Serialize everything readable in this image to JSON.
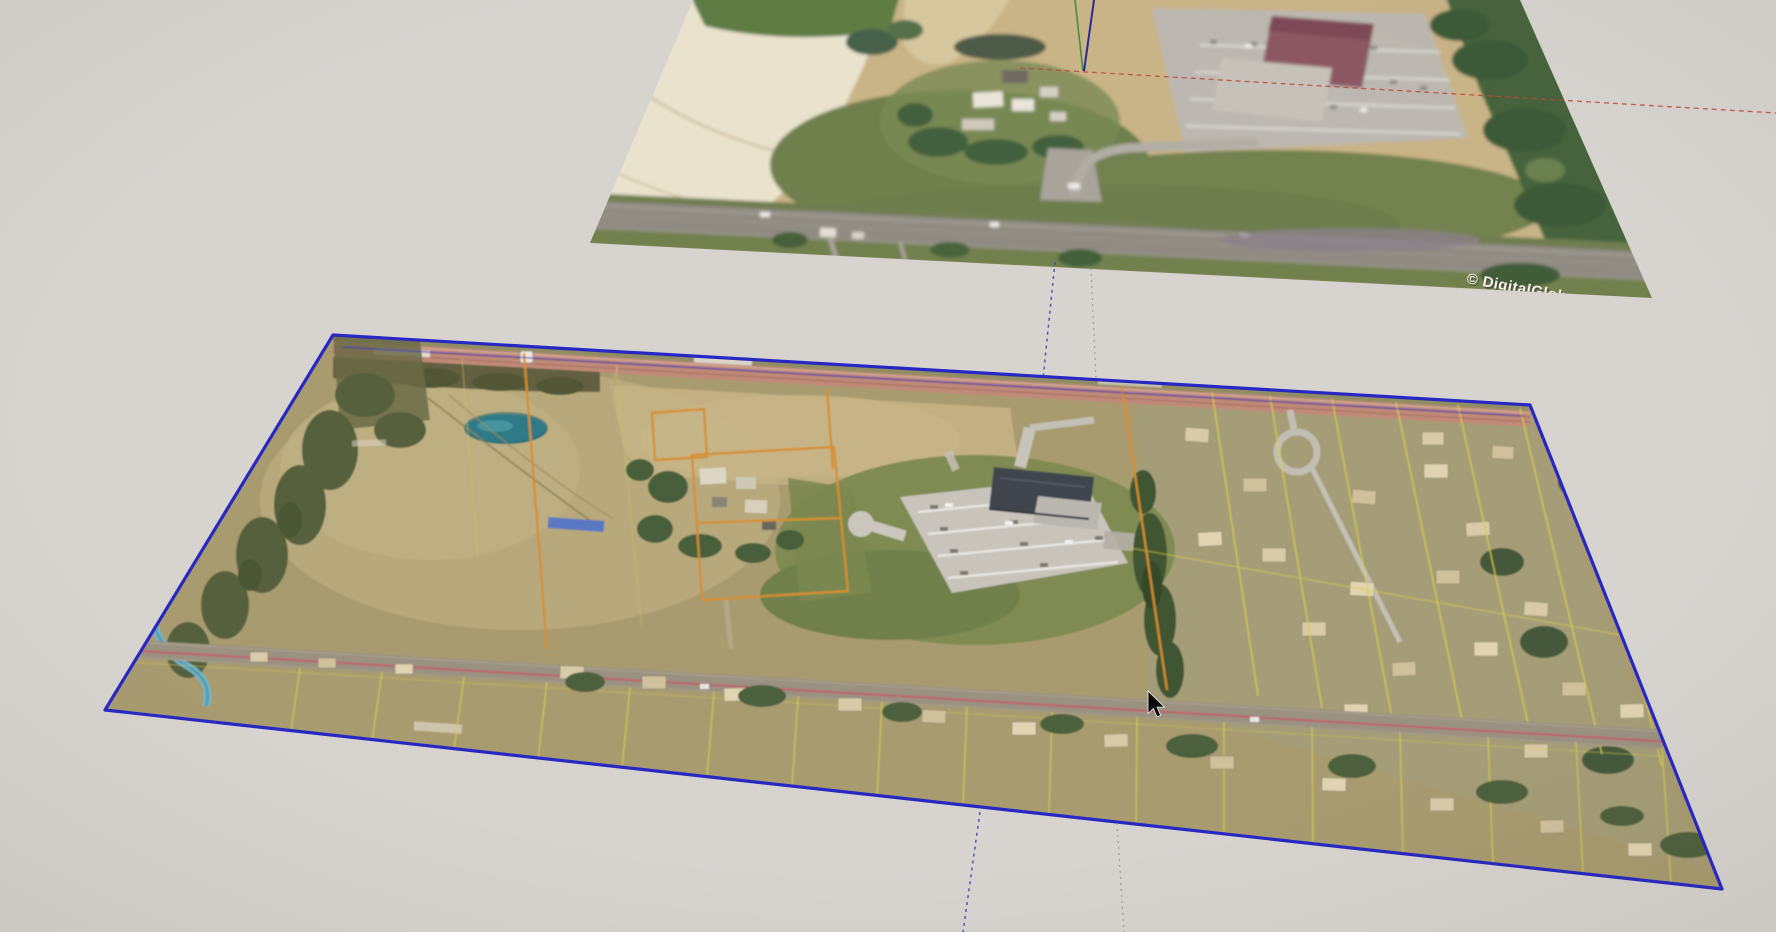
{
  "viewport": {
    "width": 1776,
    "height": 932,
    "background": "#d7d4d0"
  },
  "watermark": {
    "text": "© DigitalGlobe",
    "color": "#f4f1ea",
    "shadow_color": "#45453f"
  },
  "images": {
    "terrain": {
      "label": "satellite-terrain-snapshot",
      "corners": [
        [
          693,
          0
        ],
        [
          1520,
          0
        ],
        [
          1652,
          298
        ],
        [
          590,
          243
        ]
      ],
      "selected": false
    },
    "aerial": {
      "label": "imported-aerial-parcel-image",
      "corners": [
        [
          333,
          335
        ],
        [
          1530,
          405
        ],
        [
          1722,
          889
        ],
        [
          105,
          710
        ]
      ],
      "selected": true,
      "selection_color": "#2727c4"
    }
  },
  "axes": {
    "origin": {
      "x": 1083,
      "y": 72
    },
    "segments": [
      {
        "name": "green-axis-up",
        "x1": 1075,
        "y1": 0,
        "x2": 1083,
        "y2": 71,
        "color": "#3f8a3f",
        "width": 1.6,
        "dash": "",
        "opacity": 0.95
      },
      {
        "name": "blue-axis-up",
        "x1": 1094,
        "y1": 0,
        "x2": 1084,
        "y2": 71,
        "color": "#23239a",
        "width": 2,
        "dash": "",
        "opacity": 0.95
      },
      {
        "name": "red-axis-right",
        "x1": 1020,
        "y1": 68,
        "x2": 1776,
        "y2": 113,
        "color": "#c0453d",
        "width": 1.3,
        "dash": "5,4",
        "opacity": 0.85
      },
      {
        "name": "blue-axis-down-upper",
        "x1": 1055,
        "y1": 262,
        "x2": 1043,
        "y2": 379,
        "color": "#3a3ab8",
        "width": 1.4,
        "dash": "3,4",
        "opacity": 0.9
      },
      {
        "name": "green-axis-down-upper",
        "x1": 1091,
        "y1": 268,
        "x2": 1096,
        "y2": 379,
        "color": "#8a8a82",
        "width": 1.1,
        "dash": "2,4",
        "opacity": 0.8
      },
      {
        "name": "blue-axis-down-lower",
        "x1": 980,
        "y1": 812,
        "x2": 963,
        "y2": 932,
        "color": "#3a3ab8",
        "width": 1.4,
        "dash": "3,4",
        "opacity": 0.9
      },
      {
        "name": "green-axis-down-lower",
        "x1": 1117,
        "y1": 823,
        "x2": 1124,
        "y2": 932,
        "color": "#8a8a82",
        "width": 1.1,
        "dash": "2,4",
        "opacity": 0.8
      }
    ]
  },
  "cursor": {
    "x": 1148,
    "y": 691,
    "type": "arrow"
  }
}
